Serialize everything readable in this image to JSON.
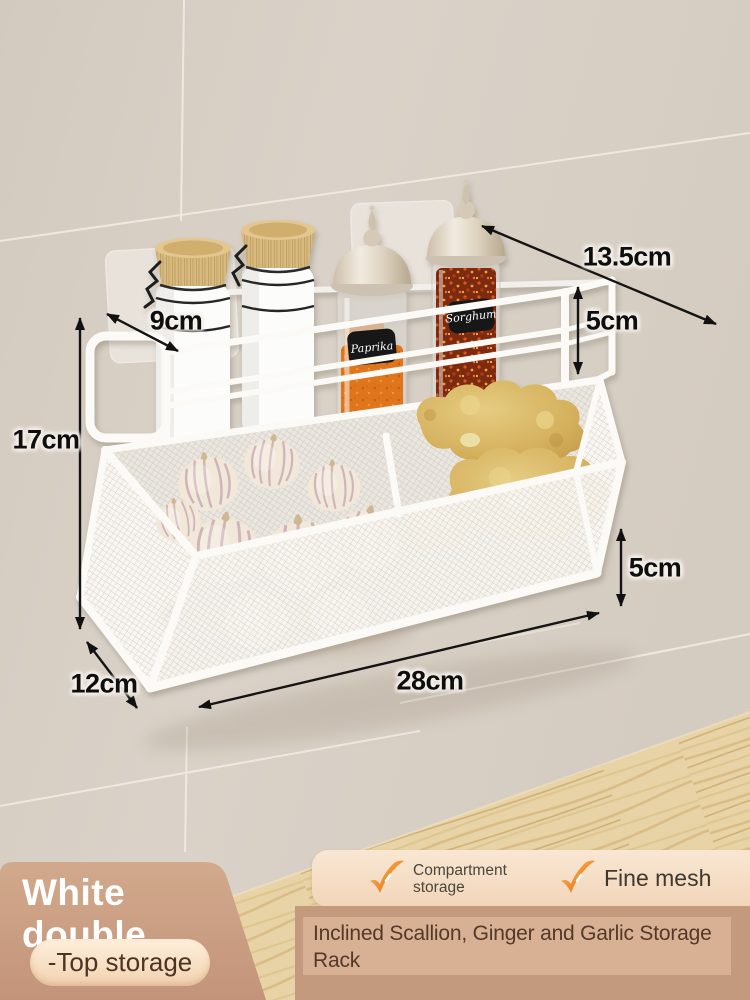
{
  "product": {
    "title": "Inclined Scallion, Ginger and Garlic Storage Rack",
    "variant_name": "White double",
    "variant_tag": "-Top storage",
    "features": [
      {
        "label": "Compartment storage",
        "icon": "check-icon"
      },
      {
        "label": "Fine mesh",
        "icon": "check-icon"
      }
    ]
  },
  "dimensions": {
    "top_shelf_diagonal": "13.5cm",
    "top_rail_height": "5cm",
    "top_shelf_depth": "9cm",
    "overall_height": "17cm",
    "base_depth": "12cm",
    "overall_width": "28cm",
    "front_lip_height": "5cm"
  },
  "scene": {
    "spice_jar_labels": [
      "Paprika",
      "Sorghum"
    ],
    "basket_contents": [
      "garlic",
      "ginger"
    ]
  },
  "colors": {
    "wall": "#d8d0c6",
    "wood": "#e8d3a6",
    "wood_dark": "#daa74a",
    "panel_tan": "#cba083",
    "pill_cream": "#fbe6cf",
    "card_cream": "#f6e1c9",
    "strip": "#c49a7e",
    "strip_inner": "#d8b094",
    "check_orange": "#ef9030",
    "text_brown": "#53392a",
    "dimension_text": "#0e0e0e",
    "rack_white": "#fbfaf7"
  }
}
